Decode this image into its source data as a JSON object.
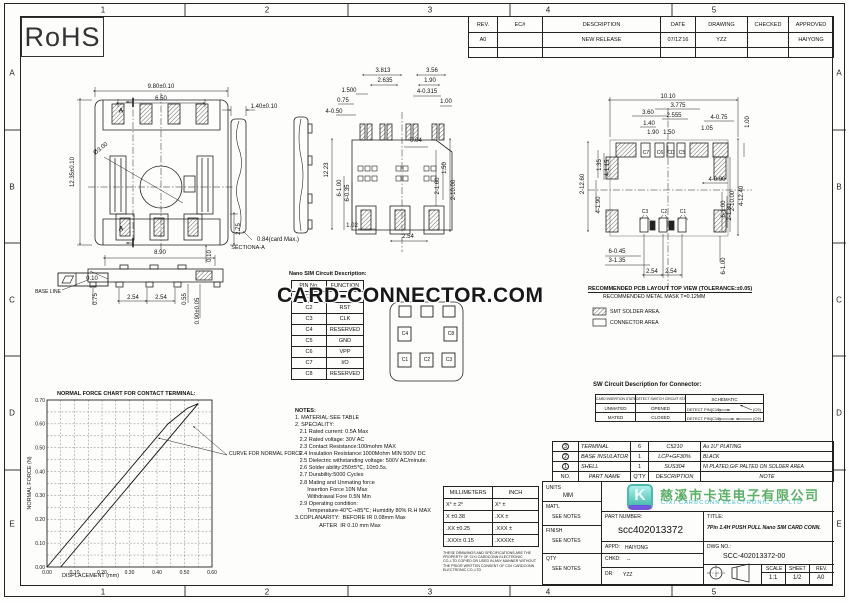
{
  "sheet": {
    "rohs": "RoHS",
    "zone_cols": [
      "1",
      "2",
      "3",
      "4",
      "5"
    ],
    "zone_rows": [
      "A",
      "B",
      "C",
      "D",
      "E"
    ]
  },
  "revision_table": {
    "headers": [
      "REV.",
      "EC#",
      "DESCRIPTION",
      "DATE",
      "DRAWING",
      "CHECKED",
      "APPROVED"
    ],
    "row": [
      "A0",
      "",
      "NEW RELEASE",
      "07/12'16",
      "YZZ",
      "",
      "HAIYONG"
    ]
  },
  "watermark": {
    "text": "CARD-CONNECTOR.COM"
  },
  "company": {
    "logo_letter": "K",
    "name_cn": "慈溪市卡连电子有限公司",
    "name_en": "CIXI CARDCONN ELECTRONIC CO. LTD"
  },
  "views": {
    "front": {
      "dims": [
        "9.80±0.10",
        "6.50",
        "12.35±0.10",
        "Ø3.00",
        "2.75",
        "0.10",
        "A",
        "A"
      ]
    },
    "profile": {
      "dims": [
        "8.90",
        "0.10",
        "BASE LINE",
        "0.75",
        "2.54",
        "2.54",
        "0.55",
        "0.90±0.05"
      ]
    },
    "section": {
      "dims": [
        "1.40±0.10",
        "0.84(card Max.)",
        "SECTIONA-A"
      ]
    },
    "bottom": {
      "dims": [
        "3.813",
        "3.56",
        "2.635",
        "1.90",
        "1.500",
        "4-0.315",
        "0.75",
        "1.00",
        "4-0.50",
        "0.04",
        "12.23",
        "6-1.00",
        "6-0.35",
        "2-1.60",
        "1.50",
        "2-10.00",
        "1.02",
        "2.54"
      ]
    },
    "pcb": {
      "dims": [
        "10.10",
        "3.775",
        "3.60",
        "2.555",
        "1.40",
        "4-0.75",
        "1.00",
        "1.90",
        "1.50",
        "1.05",
        "1.35",
        "4-1.15",
        "4-1.90",
        "2-12.60",
        "4-0.90",
        "2-10.00",
        "4-12.40",
        "6-1.00",
        "2-1.80",
        "6-0.45",
        "3-1.35",
        "2.54",
        "2.54",
        "6-1.00"
      ],
      "pads_top": [
        "C7",
        "C6",
        "CD",
        "C5"
      ],
      "pads_bottom": [
        "C3",
        "C2",
        "C1"
      ],
      "note1": "RECOMMENDED PCB LAYOUT TOP VIEW (TOLERANCE:±0.05)",
      "note2": "RECOMMENDED METAL MASK T=0.12MM",
      "legend": [
        "SMT SOLDER AREA.",
        "CONNECTOR AREA"
      ]
    }
  },
  "pin_table": {
    "title": "Nano SIM Circuit Description:",
    "headers": [
      "PIN No.",
      "FUNCTION"
    ],
    "rows": [
      [
        "C1",
        "VCC"
      ],
      [
        "C2",
        "RST"
      ],
      [
        "C3",
        "CLK"
      ],
      [
        "C4",
        "RESERVED"
      ],
      [
        "C5",
        "GND"
      ],
      [
        "C6",
        "VPP"
      ],
      [
        "C7",
        "I/O"
      ],
      [
        "C8",
        "RESERVED"
      ]
    ]
  },
  "sim_card": {
    "pads": [
      "C4",
      "C8",
      "C1",
      "C2",
      "C3"
    ]
  },
  "sw_table": {
    "title": "SW Circuit Description for Connector:",
    "headers": [
      "CARD INSERTION STATE",
      "DETECT SWITCH CIRCUIT STATE",
      "SCHEMATIC"
    ],
    "rows": [
      [
        "UNMATED",
        "OPENED"
      ],
      [
        "MATED",
        "CLOSED"
      ]
    ],
    "schematic": {
      "pin": "DETECT PIN(C10)",
      "gnd": "(C9)"
    }
  },
  "notes": {
    "title": "NOTES:",
    "lines": [
      "1. MATERIAL:SEE TABLE",
      "2. SPECIALITY:",
      "   2.1 Rated current: 0.5A Max",
      "   2.2 Rated voltage: 30V AC",
      "   2.3 Contact Resistance:100mohm MAX",
      "   2.4 Insulation Resistance:1000Mohm MIN 500V DC",
      "   2.5 Dielectric withstanding voltage: 500V AC/minute.",
      "   2.6 Solder ability:250±5℃, 10±0.5s.",
      "   2.7 Durability:5000 Cycles",
      "   2.8 Mating and Unmating force",
      "        Insertion Force 10N Max",
      "        Withdrawal Fore 0.5N Min",
      "   2.9 Operating condition:",
      "        Temperature-40℃-+85℃; Humidity 80% R.H MAX",
      "3.COPLANARITY:  BEFORE IR 0.08mm Max",
      "                AFTER  IR 0.10 mm Max"
    ]
  },
  "chart_data": {
    "type": "line",
    "title": "NORMAL FORCE CHART FOR CONTACT TERMINAL:",
    "xlabel": "DISPLACEMENT (mm)",
    "ylabel": "NORMAL FORCE (N)",
    "xlim": [
      0,
      0.6
    ],
    "ylim": [
      0,
      0.7
    ],
    "xticks": [
      "0.00",
      "0.10",
      "0.20",
      "0.30",
      "0.40",
      "0.50",
      "0.60"
    ],
    "yticks": [
      "0.00",
      "0.10",
      "0.20",
      "0.30",
      "0.40",
      "0.50",
      "0.60",
      "0.70"
    ],
    "grid": "dashed",
    "annotation": "CURVE FOR NORMAL FORCE",
    "series": [
      {
        "name": "loading",
        "x": [
          0.0,
          0.44,
          0.51,
          0.55
        ],
        "y": [
          0.0,
          0.6,
          0.665,
          0.685
        ]
      },
      {
        "name": "unloading",
        "x": [
          0.05,
          0.55
        ],
        "y": [
          0.0,
          0.685
        ]
      }
    ]
  },
  "tolerance_table": {
    "headers": [
      "MILLIMETERS",
      "INCH"
    ],
    "rows": [
      [
        "X° ± 2°",
        "X° ±"
      ],
      [
        "X  ±0.38",
        ".XX ±"
      ],
      [
        ".XX ±0.25",
        ".XXX ±"
      ],
      [
        ".XXX± 0.15",
        ".XXXX±"
      ]
    ],
    "disclaimer": "THESE DRAWINGS AND SPECIFICATIONS ARE THE PROPERTY OF CIXI CARDCONN ELECTRONIC CO.,LTD COPIED OR USED IN ANY MANNER WITHOUT THE PRIOR WRITTEN CONSENT OF CIXI CARDCONN ELECTRONIC CO.,LTD"
  },
  "parts_table": {
    "headers": [
      "NO.",
      "PART NAME",
      "Q'TY",
      "DESCRIPTION",
      "NOTE"
    ],
    "rows": [
      [
        "3",
        "TERMINAL",
        "6",
        "C5210",
        "Au 1U\" PLATING"
      ],
      [
        "2",
        "BASE INSULATOR",
        "1",
        "LCP+GF30%",
        "BLACK"
      ],
      [
        "1",
        "SHELL",
        "1",
        "SUS304",
        "NI PLATED,G/F PALTED ON SOLDER AREA"
      ]
    ]
  },
  "title_block": {
    "units_label": "UNITS",
    "units": "MM",
    "matl_label": "MAT'L",
    "matl": "SEE NOTES",
    "finish_label": "FINISH",
    "finish": "SEE NOTES",
    "qty_label": "QTY",
    "qty": "SEE NOTES",
    "part_number_label": "PART NUMBER:",
    "part_number": "scc402013372",
    "appd_label": "APPD:",
    "appd": "HAIYONG",
    "chkd_label": "CHKD:",
    "chkd": "--",
    "dr_label": "DR:",
    "dr": "YZZ",
    "title_label": "TITLE:",
    "title": "7Pin 1.4H PUSH PULL Nano SIM CARD CONN.",
    "dwg_label": "DWG NO.:",
    "dwg_no": "SCC-402013372-00",
    "scale_label": "SCALE",
    "scale": "1:1",
    "sheet_label": "SHEET",
    "sheet": "1/2",
    "rev_label": "REV.",
    "rev": "A0"
  }
}
